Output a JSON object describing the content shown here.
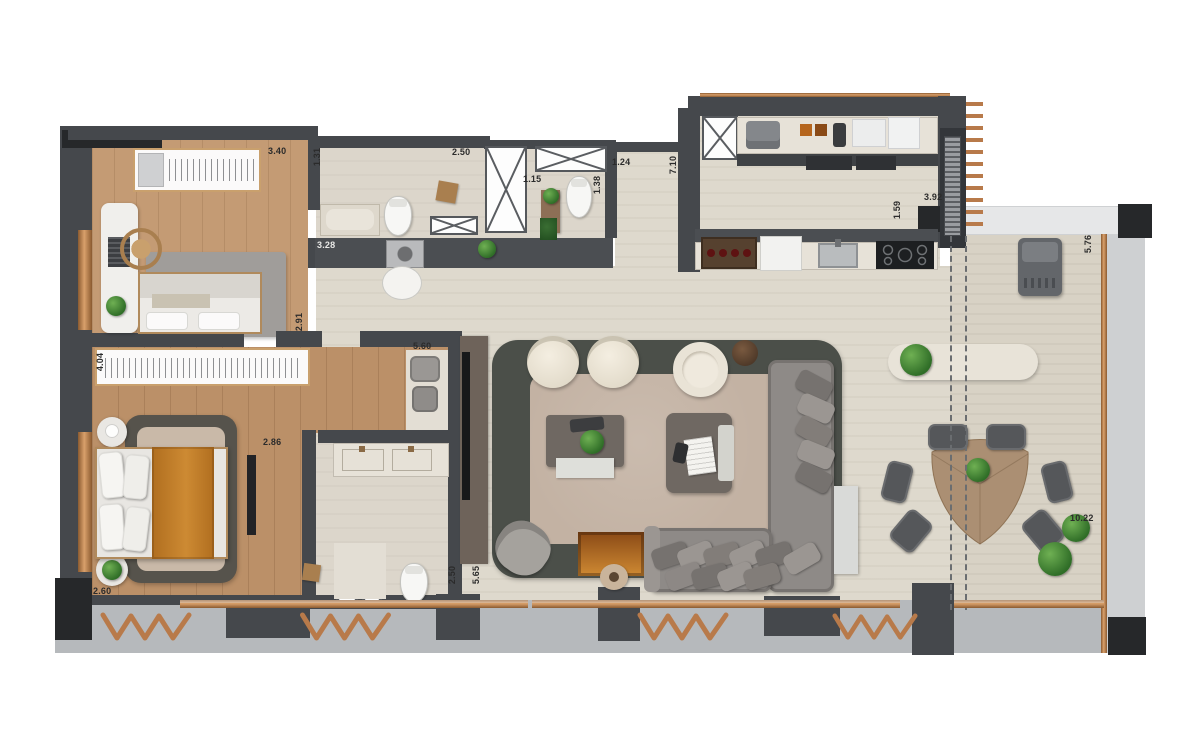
{
  "labels": [
    {
      "id": "dim-bedroom1-width",
      "text": "3.40"
    },
    {
      "id": "dim-bath1-entry",
      "text": "1.31"
    },
    {
      "id": "dim-bath1-width",
      "text": "2.50"
    },
    {
      "id": "dim-powder-width",
      "text": "1.15"
    },
    {
      "id": "dim-powder-depth",
      "text": "1.38"
    },
    {
      "id": "dim-hall-width",
      "text": "1.24"
    },
    {
      "id": "dim-hall-length",
      "text": "7.10"
    },
    {
      "id": "dim-laundry-width",
      "text": "3.28"
    },
    {
      "id": "dim-bedroom1-depth",
      "text": "2.91"
    },
    {
      "id": "dim-master-wardrobe",
      "text": "4.04"
    },
    {
      "id": "dim-closet-length",
      "text": "5.60"
    },
    {
      "id": "dim-master-width",
      "text": "2.86"
    },
    {
      "id": "dim-master-depth",
      "text": "2.60"
    },
    {
      "id": "dim-masterbath-width",
      "text": "2.50"
    },
    {
      "id": "dim-masterbath-length",
      "text": "5.65"
    },
    {
      "id": "dim-kitchen-pass",
      "text": "1.59"
    },
    {
      "id": "dim-grill-wall",
      "text": "3.92"
    },
    {
      "id": "dim-terrace-depth",
      "text": "5.76"
    },
    {
      "id": "dim-terrace-length",
      "text": "10.22"
    }
  ],
  "colors": {
    "wall": "#45484c",
    "wall_dark": "#26282a",
    "wood_floor": "#c49b74",
    "wood_floor_master": "#bb9068",
    "tile_floor": "#dcd6cb",
    "stone_floor": "#ded9cd",
    "terrace_paving": "#b6b9bc",
    "copper_frame": "#b87a4a",
    "rug_border": "#4b4f49",
    "rug_center": "#c3b2a3",
    "sofa_grey": "#8e8a87",
    "armchair_cream": "#eae4d7",
    "bed_throw_orange": "#c07b28",
    "plant_green": "#3f7d33",
    "dining_table_wood": "#ab8f73"
  }
}
